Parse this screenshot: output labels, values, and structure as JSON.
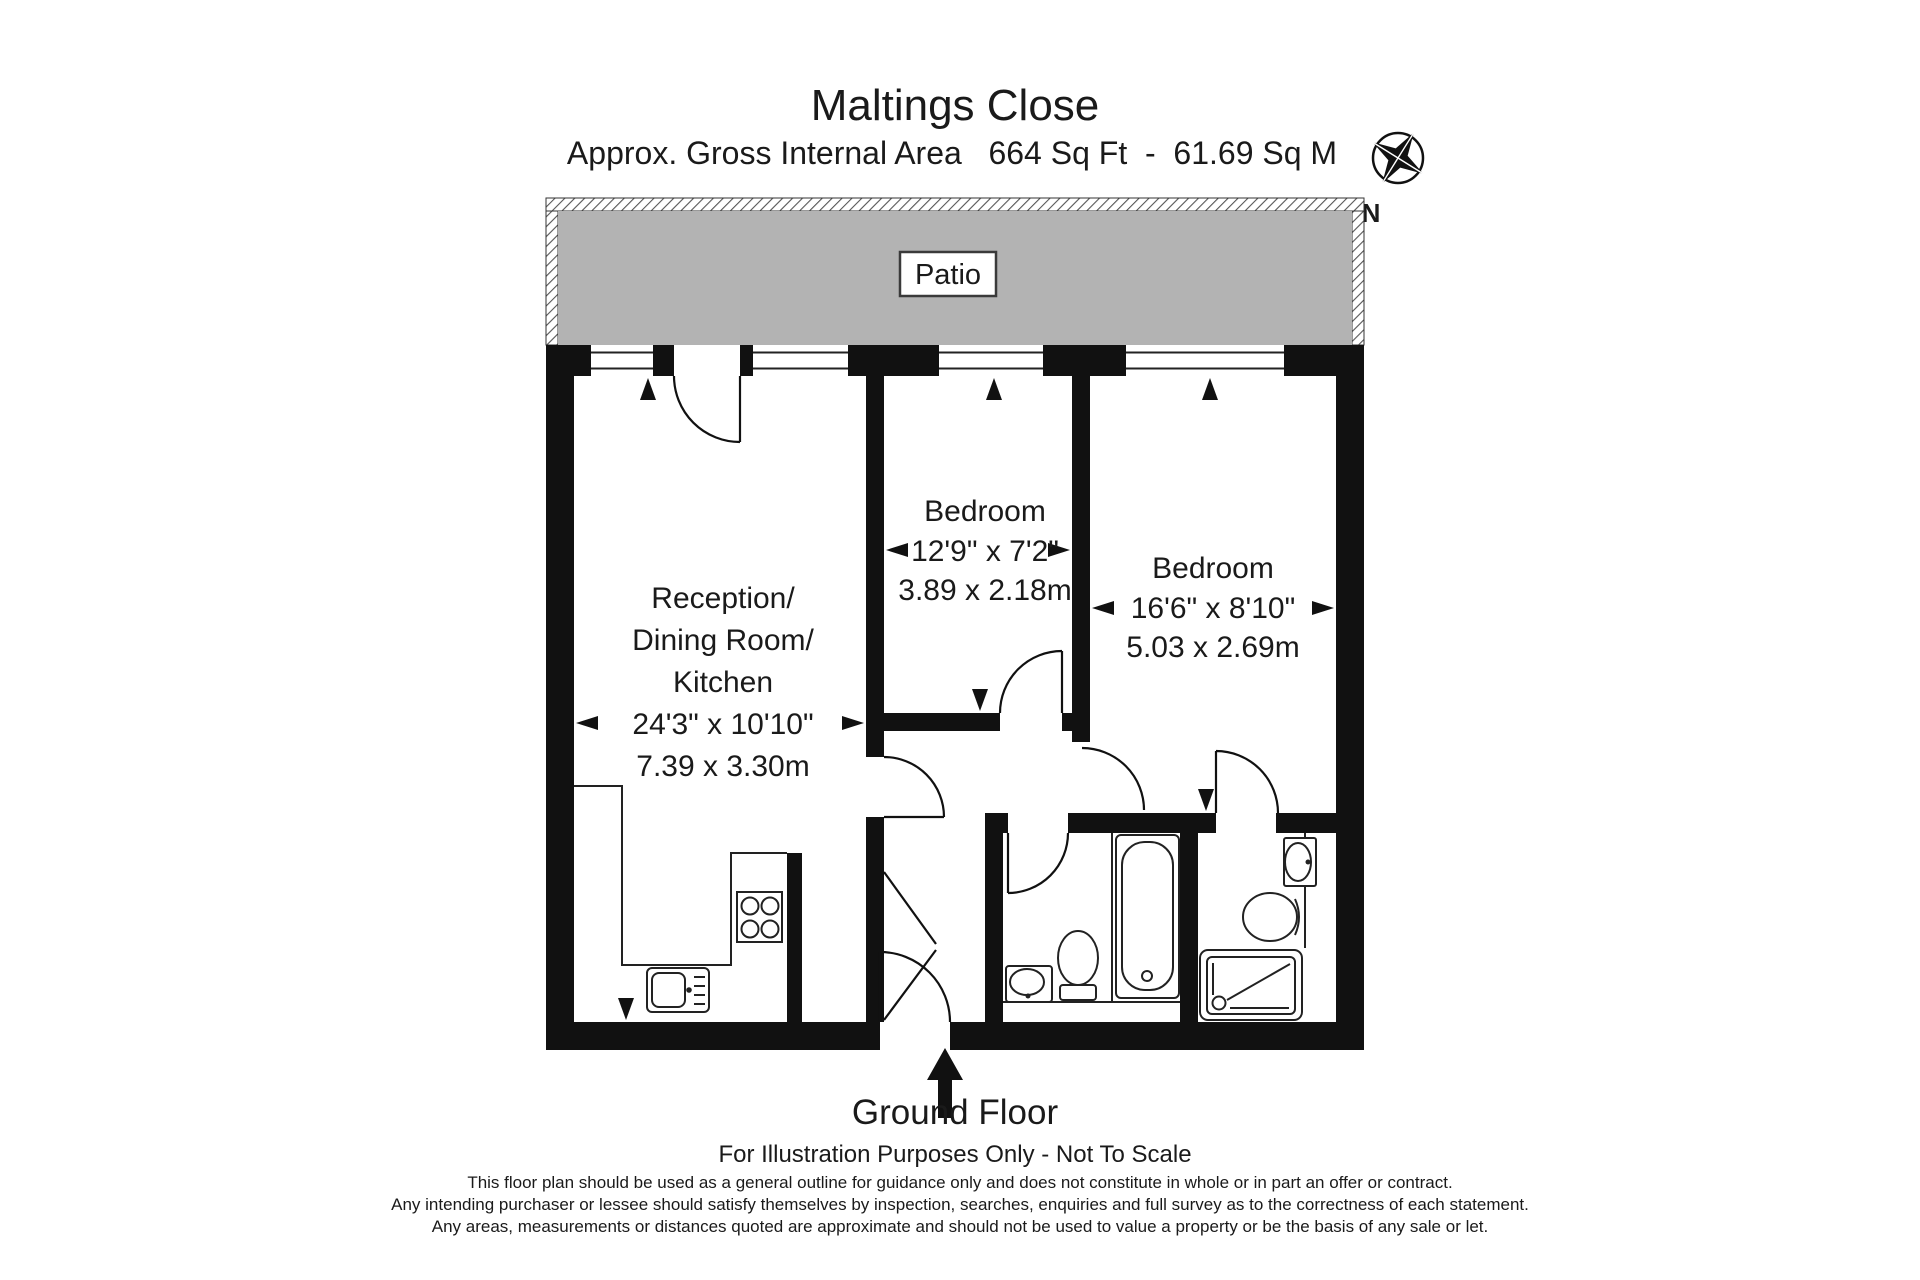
{
  "header": {
    "title": "Maltings Close",
    "subtitle": "Approx. Gross Internal Area   664 Sq Ft  -  61.69 Sq M",
    "compass_label": "N"
  },
  "plan": {
    "patio_label": "Patio",
    "rooms": {
      "reception": {
        "lines": [
          "Reception/",
          "Dining Room/",
          "Kitchen",
          "24'3\" x 10'10\"",
          "7.39 x 3.30m"
        ]
      },
      "bedroom1": {
        "lines": [
          "Bedroom",
          "12'9\" x 7'2\"",
          "3.89 x 2.18m"
        ]
      },
      "bedroom2": {
        "lines": [
          "Bedroom",
          "16'6\" x 8'10\"",
          "5.03 x 2.69m"
        ]
      }
    }
  },
  "footer": {
    "floor_label": "Ground Floor",
    "scale_note": "For Illustration Purposes Only - Not To Scale",
    "disclaimer_lines": [
      "This floor plan should be used as a general outline for guidance only and does not constitute in whole or in part an offer or contract.",
      "Any intending purchaser or lessee should satisfy themselves by inspection, searches, enquiries and full survey as to the correctness of each statement.",
      "Any areas, measurements or distances quoted are approximate and should not be used to value a property or be the basis of any sale or let."
    ]
  },
  "colors": {
    "wall": "#111111",
    "patio": "#b3b3b3",
    "text": "#1a1a1a",
    "hatch": "#555555"
  }
}
